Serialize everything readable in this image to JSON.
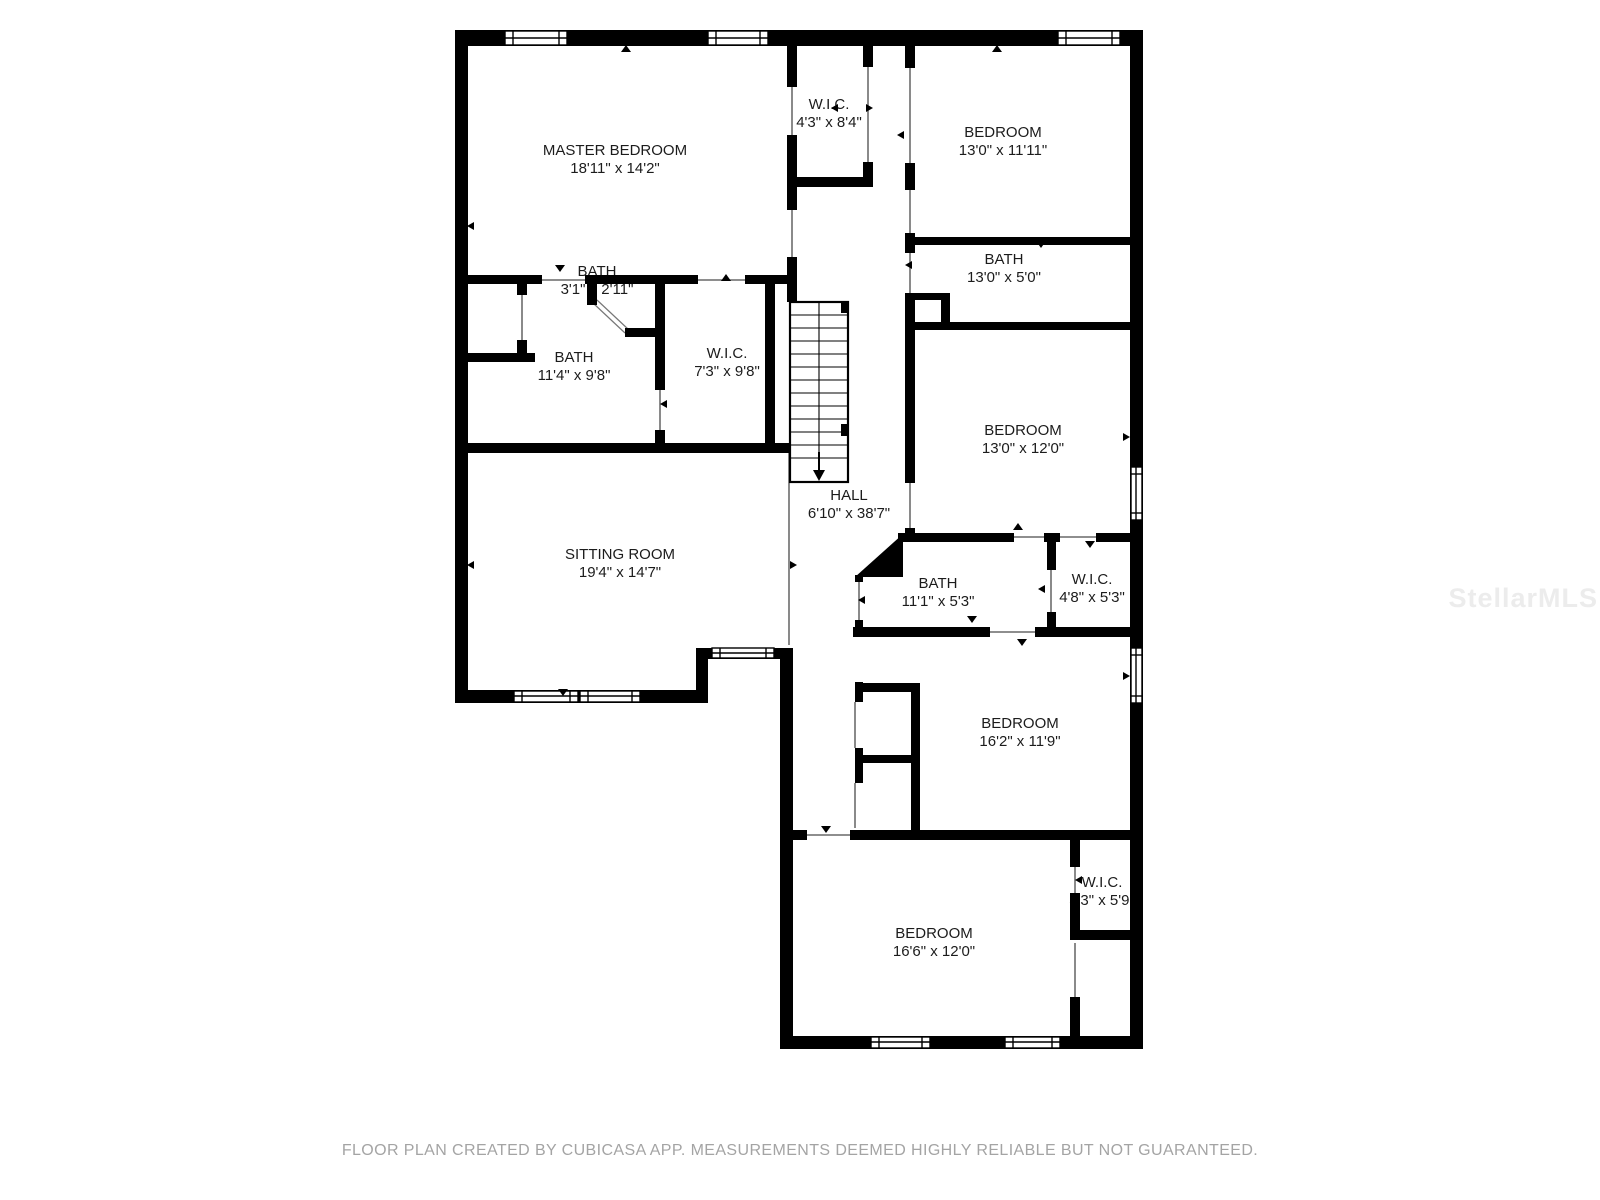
{
  "floor_plan": {
    "rooms": [
      {
        "name": "MASTER BEDROOM",
        "dims": "18'11\" x 14'2\""
      },
      {
        "name": "W.I.C.",
        "dims": "4'3\" x 8'4\""
      },
      {
        "name": "BEDROOM",
        "dims": "13'0\" x 11'11\""
      },
      {
        "name": "BATH",
        "dims": "13'0\" x 5'0\""
      },
      {
        "name": "BATH",
        "dims": "3'1\" x 2'11\""
      },
      {
        "name": "BATH",
        "dims": "11'4\" x 9'8\""
      },
      {
        "name": "W.I.C.",
        "dims": "7'3\" x 9'8\""
      },
      {
        "name": "HALL",
        "dims": "6'10\" x 38'7\""
      },
      {
        "name": "BEDROOM",
        "dims": "13'0\" x 12'0\""
      },
      {
        "name": "SITTING ROOM",
        "dims": "19'4\" x 14'7\""
      },
      {
        "name": "BATH",
        "dims": "11'1\" x 5'3\""
      },
      {
        "name": "W.I.C.",
        "dims": "4'8\" x 5'3\""
      },
      {
        "name": "BEDROOM",
        "dims": "16'2\" x 11'9\""
      },
      {
        "name": "W.I.C.",
        "dims": "3'3\" x 5'9\""
      },
      {
        "name": "BEDROOM",
        "dims": "16'6\" x 12'0\""
      }
    ],
    "footer": {
      "text": "FLOOR PLAN CREATED BY CUBICASA APP. MEASUREMENTS DEEMED HIGHLY RELIABLE BUT NOT GUARANTEED."
    },
    "watermark": {
      "text": "StellarMLS"
    },
    "colors": {
      "wall": "#000000",
      "label_text": "#1c1c1c",
      "footer_text": "#a4a4a4",
      "watermark": "#ececec"
    }
  }
}
